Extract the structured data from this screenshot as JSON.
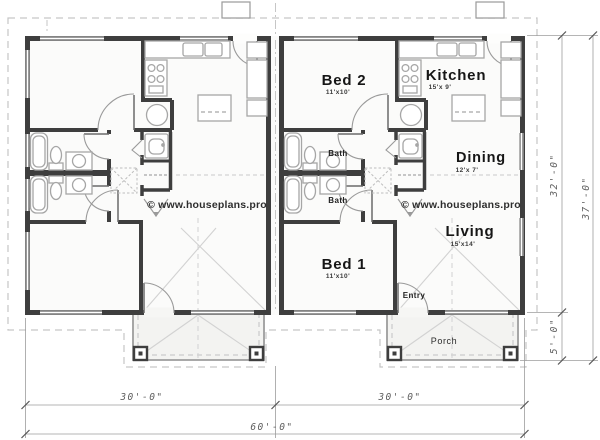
{
  "plan": {
    "watermark": "© www.houseplans.pro",
    "rooms": {
      "bed2": {
        "name": "Bed 2",
        "size": "11'x10'"
      },
      "kitchen": {
        "name": "Kitchen",
        "size": "15'x 9'"
      },
      "bath_upper": {
        "name": "Bath"
      },
      "bath_lower": {
        "name": "Bath"
      },
      "dining": {
        "name": "Dining",
        "size": "12'x 7'"
      },
      "living": {
        "name": "Living",
        "size": "15'x14'"
      },
      "bed1": {
        "name": "Bed 1",
        "size": "11'x10'"
      },
      "entry": {
        "name": "Entry"
      },
      "porch": {
        "name": "Porch"
      }
    },
    "dimensions": {
      "left_unit_width": "30'-0\"",
      "right_unit_width": "30'-0\"",
      "total_width": "60'-0\"",
      "house_depth": "32'-0\"",
      "porch_depth": "5'-0\"",
      "total_depth": "37'-0\""
    }
  }
}
